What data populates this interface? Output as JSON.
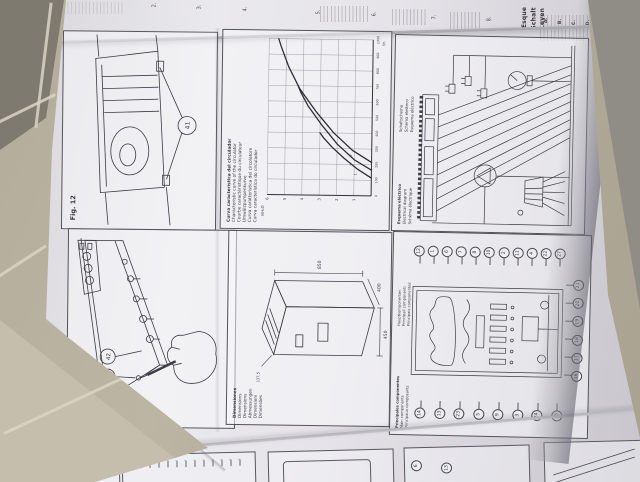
{
  "figures": {
    "fig12": {
      "label": "Fig. 12",
      "callout": "41"
    },
    "fig11": {
      "label": "Fig. 11",
      "callouts": [
        "40",
        "42"
      ]
    },
    "dimensions": {
      "captions": [
        "Dimensiones",
        "Dimensions",
        "Dimensions",
        "Abmessungen",
        "Dimensioni",
        "Dimensões"
      ],
      "values": {
        "height": "850",
        "width": "450",
        "depth": "400",
        "detail": "137,5"
      }
    },
    "electrical": {
      "captions": [
        "Esquema eléctrico",
        "Electrical diagram",
        "Schéma électrique",
        "Schaltschema",
        "Schema elettrico",
        "Esquema eléctrico"
      ]
    },
    "components": {
      "captions": [
        "Principales componentes",
        "Main components",
        "Principaux composants",
        "Hauptkomponenten",
        "Principali componenti",
        "Principais componentes"
      ],
      "callouts_right": [
        "12",
        "1",
        "6",
        "7",
        "8",
        "10",
        "2",
        "11",
        "4",
        "22",
        "27"
      ],
      "callouts_left": [
        "14",
        "13",
        "23",
        "5",
        "9",
        "3",
        "24",
        "15"
      ],
      "callouts_bottom": [
        "16",
        "17",
        "18",
        "19",
        "20",
        "21"
      ]
    }
  },
  "chart_data": {
    "type": "line",
    "title": "Curva característica del circulador",
    "captions": [
      "Curva característica del circulador",
      "Characteristic curve of the circulator",
      "Courbe caractéristique du circulateur",
      "Umwälzpumpenkurve",
      "Curva caratteristica del circolatore",
      "Curva característica do circulador"
    ],
    "xlabel": "l/h",
    "ylabel": "mH₂O",
    "xlim": [
      0,
      1000
    ],
    "ylim": [
      0,
      6
    ],
    "x_ticks": [
      0,
      100,
      200,
      300,
      400,
      500,
      600,
      700,
      800,
      900,
      1000
    ],
    "y_ticks": [
      1,
      2,
      3,
      4,
      5,
      6
    ],
    "grid": true,
    "legend_position": "on-curve",
    "series": [
      {
        "name": "1",
        "points": [
          [
            115,
            0
          ],
          [
            170,
            0.8
          ],
          [
            240,
            1.6
          ],
          [
            310,
            2.3
          ],
          [
            370,
            2.8
          ],
          [
            400,
            3.0
          ]
        ]
      },
      {
        "name": "2",
        "points": [
          [
            165,
            0
          ],
          [
            230,
            1.0
          ],
          [
            330,
            2.0
          ],
          [
            450,
            2.9
          ],
          [
            570,
            3.7
          ],
          [
            660,
            4.15
          ],
          [
            700,
            4.3
          ]
        ]
      },
      {
        "name": "3",
        "points": [
          [
            215,
            0
          ],
          [
            290,
            1.1
          ],
          [
            400,
            2.2
          ],
          [
            530,
            3.2
          ],
          [
            680,
            4.2
          ],
          [
            820,
            4.85
          ],
          [
            950,
            5.3
          ],
          [
            1000,
            5.45
          ]
        ]
      }
    ]
  },
  "top_strip": {
    "numbers": [
      "2.",
      "3.",
      "4.",
      "5.",
      "6.",
      "7.",
      "8."
    ],
    "headings": [
      "Esque",
      "Schalt",
      "Leyen"
    ],
    "letters": [
      "A.",
      "B.",
      "C.",
      "D.",
      "E."
    ]
  },
  "bottom_strip": {
    "callouts": [
      "6",
      "13"
    ]
  }
}
